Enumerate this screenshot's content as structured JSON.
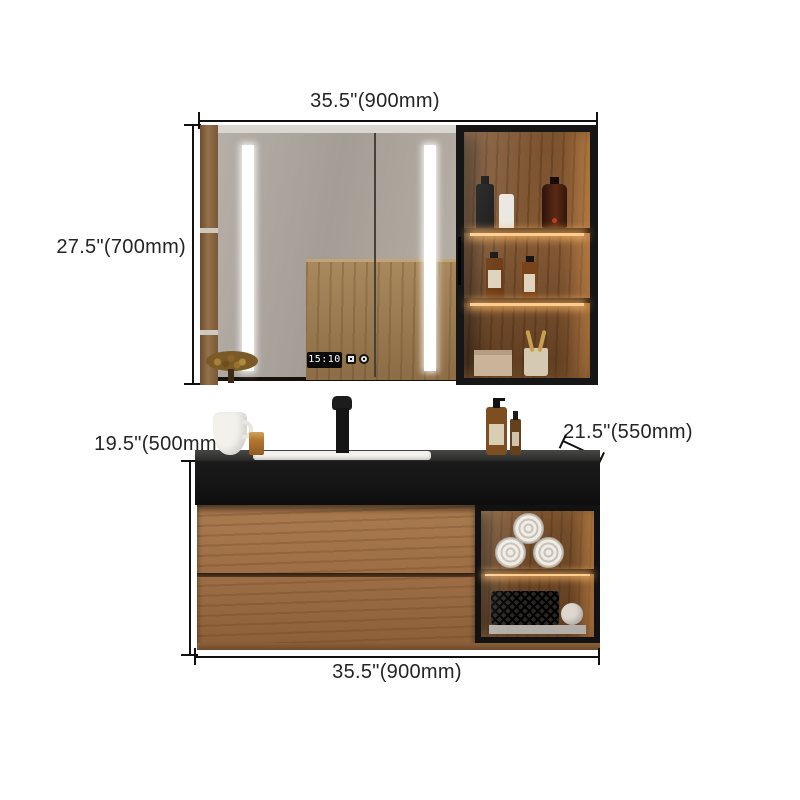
{
  "scene": {
    "type": "bathroom vanity set dimension diagram",
    "background": "#ffffff",
    "annotation_color": "#242424",
    "line_color": "#101010"
  },
  "dimensions": {
    "mirror_width": "35.5\"(900mm)",
    "mirror_height": "27.5\"(700mm)",
    "vanity_height": "19.5\"(500mm)",
    "counter_depth": "21.5\"(550mm)",
    "vanity_width": "35.5\"(900mm)"
  },
  "mirror_cabinet": {
    "clock_time": "15:10",
    "led_color": "#ffffff",
    "display_shelves": [
      "black pump bottle, white bottle, amber bottle",
      "two labeled amber bottles",
      "beige box, cup with toothbrushes"
    ]
  },
  "vanity": {
    "counter_color": "#1a1a1a",
    "wood_color": "#9c6d44",
    "glow_color": "#ffcd8d",
    "counter_items": [
      "white pitcher",
      "amber glass",
      "soap pump bottle",
      "dropper bottle"
    ],
    "open_shelf_items": [
      "rolled towels",
      "wire basket with towel"
    ]
  }
}
